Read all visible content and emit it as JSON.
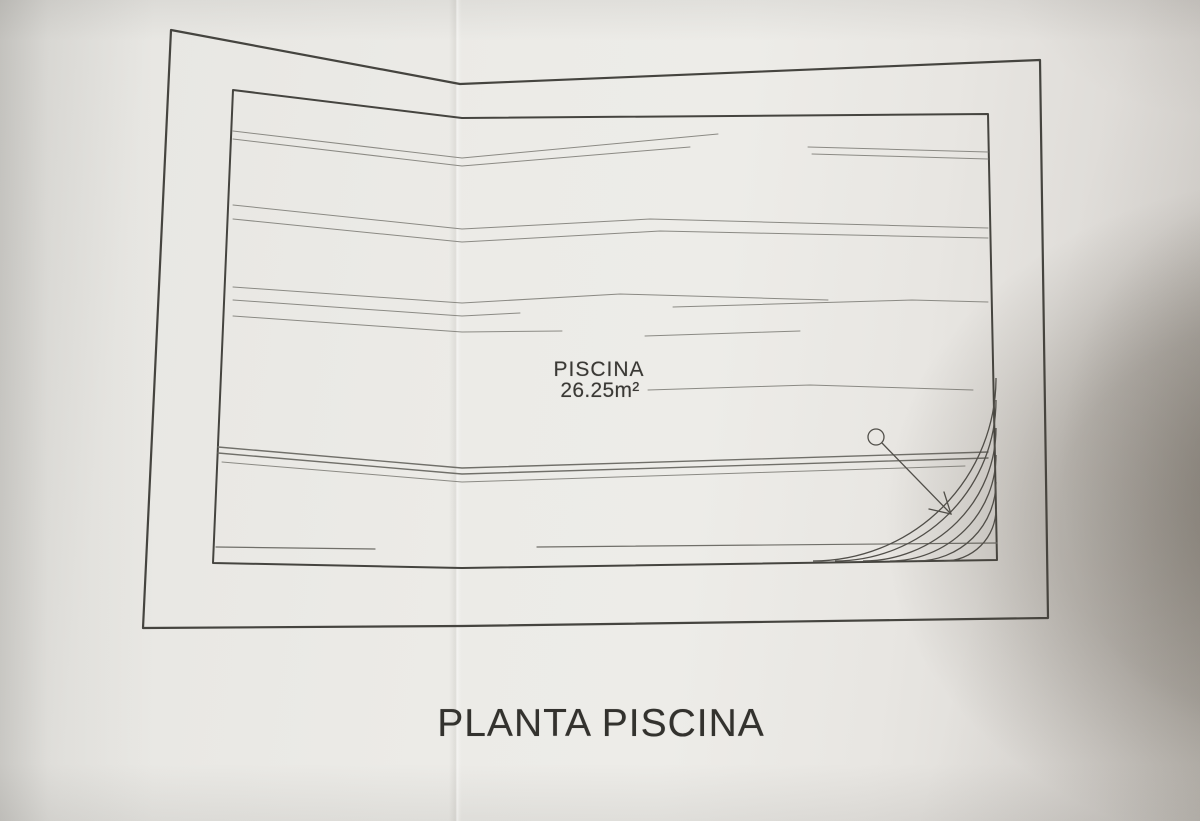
{
  "document": {
    "drawing_title": "PLANTA PISCINA",
    "pool_label": "PISCINA",
    "pool_area": "26.25m²"
  },
  "drawing": {
    "border_color": "#45443f",
    "water_line_color": "#8b8a84",
    "dark_water_line_color": "#706f69",
    "accent_line_color": "#514f4a",
    "outer_border": [
      [
        171,
        30
      ],
      [
        460,
        84
      ],
      [
        1040,
        60
      ],
      [
        1048,
        618
      ],
      [
        462,
        626
      ],
      [
        143,
        628
      ]
    ],
    "inner_border": [
      [
        233,
        90
      ],
      [
        462,
        118
      ],
      [
        988,
        114
      ],
      [
        997,
        560
      ],
      [
        462,
        568
      ],
      [
        213,
        563
      ]
    ],
    "water_lines": [
      {
        "points": [
          [
            233,
            131
          ],
          [
            462,
            158
          ],
          [
            718,
            134
          ]
        ],
        "w": 1,
        "tone": "light"
      },
      {
        "points": [
          [
            233,
            139
          ],
          [
            462,
            166
          ],
          [
            690,
            147
          ]
        ],
        "w": 1,
        "tone": "light"
      },
      {
        "points": [
          [
            808,
            147
          ],
          [
            988,
            152
          ]
        ],
        "w": 1,
        "tone": "light"
      },
      {
        "points": [
          [
            812,
            154
          ],
          [
            988,
            159
          ]
        ],
        "w": 1,
        "tone": "light"
      },
      {
        "points": [
          [
            233,
            205
          ],
          [
            462,
            229
          ],
          [
            650,
            219
          ],
          [
            988,
            228
          ]
        ],
        "w": 1,
        "tone": "light"
      },
      {
        "points": [
          [
            233,
            219
          ],
          [
            462,
            242
          ],
          [
            660,
            231
          ],
          [
            988,
            238
          ]
        ],
        "w": 1,
        "tone": "light"
      },
      {
        "points": [
          [
            233,
            287
          ],
          [
            462,
            303
          ],
          [
            620,
            294
          ],
          [
            828,
            300
          ]
        ],
        "w": 1,
        "tone": "light"
      },
      {
        "points": [
          [
            233,
            300
          ],
          [
            462,
            316
          ],
          [
            520,
            313
          ]
        ],
        "w": 1,
        "tone": "light"
      },
      {
        "points": [
          [
            673,
            307
          ],
          [
            912,
            300
          ],
          [
            988,
            302
          ]
        ],
        "w": 1,
        "tone": "light"
      },
      {
        "points": [
          [
            233,
            316
          ],
          [
            462,
            332
          ],
          [
            562,
            331
          ]
        ],
        "w": 1,
        "tone": "light"
      },
      {
        "points": [
          [
            645,
            336
          ],
          [
            800,
            331
          ]
        ],
        "w": 1,
        "tone": "light"
      },
      {
        "points": [
          [
            648,
            390
          ],
          [
            810,
            385
          ],
          [
            973,
            390
          ]
        ],
        "w": 1,
        "tone": "light"
      },
      {
        "points": [
          [
            218,
            447
          ],
          [
            462,
            468
          ],
          [
            988,
            452
          ]
        ],
        "w": 1.4,
        "tone": "dark"
      },
      {
        "points": [
          [
            218,
            453
          ],
          [
            462,
            474
          ],
          [
            988,
            458
          ]
        ],
        "w": 1.4,
        "tone": "dark"
      },
      {
        "points": [
          [
            222,
            462
          ],
          [
            462,
            482
          ],
          [
            965,
            466
          ]
        ],
        "w": 1,
        "tone": "light"
      },
      {
        "points": [
          [
            216,
            547
          ],
          [
            375,
            549
          ]
        ],
        "w": 1.2,
        "tone": "dark"
      },
      {
        "points": [
          [
            537,
            547
          ],
          [
            997,
            543
          ]
        ],
        "w": 1.2,
        "tone": "dark"
      }
    ],
    "stairs": {
      "cx": 996,
      "cy": 561,
      "radii": [
        52,
        79,
        106,
        133,
        161,
        183
      ]
    },
    "direction_marker": {
      "circle": {
        "cx": 876,
        "cy": 437,
        "r": 8
      },
      "line": [
        [
          882,
          443
        ],
        [
          951,
          514
        ]
      ],
      "arrowhead": [
        [
          929,
          509
        ],
        [
          951,
          514
        ],
        [
          944,
          492
        ]
      ]
    }
  },
  "photo": {
    "paper_color": "#ebebe9",
    "shadow_color": "#6e675c"
  }
}
